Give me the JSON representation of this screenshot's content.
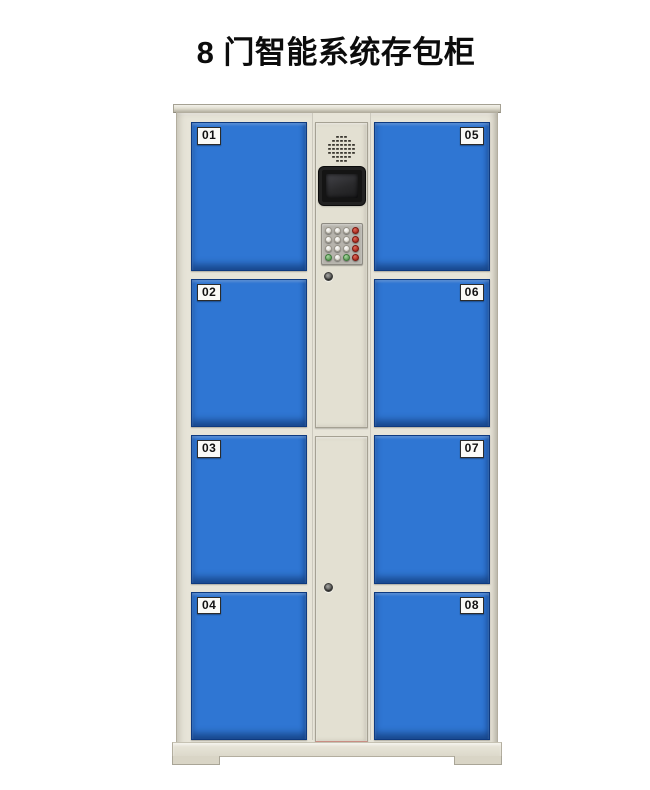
{
  "title": "8 门智能系统存包柜",
  "cabinet": {
    "left_column_doors": [
      "01",
      "02",
      "03",
      "04"
    ],
    "right_column_doors": [
      "05",
      "06",
      "07",
      "08"
    ],
    "control_panel": {
      "keypad_layout": [
        [
          "w",
          "w",
          "w",
          "r"
        ],
        [
          "w",
          "w",
          "w",
          "r"
        ],
        [
          "w",
          "w",
          "w",
          "r"
        ],
        [
          "g",
          "w",
          "g",
          "r"
        ]
      ]
    },
    "colors": {
      "door_blue": "#2f76d3",
      "door_outline": "#0e3a80",
      "body_cream": "#e7e4d8",
      "panel_cream": "#e3e0d2",
      "screen_bezel": "#141414",
      "keypad_red": "#a72a1e",
      "keypad_green": "#5d9b57",
      "label_bg": "#fafaf7",
      "label_text": "#111111"
    }
  }
}
